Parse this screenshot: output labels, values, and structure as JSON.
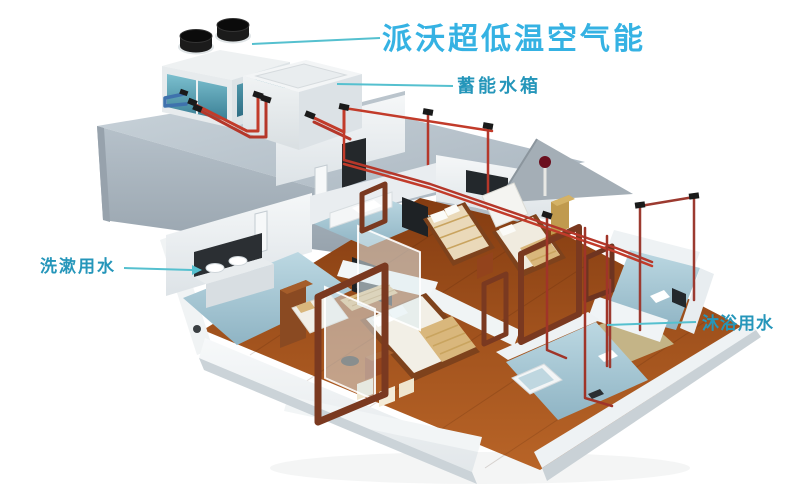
{
  "labels": {
    "system_title": {
      "text": "派沃超低温空气能",
      "color": "#35b2e3"
    },
    "storage_tank": {
      "text": "蓄能水箱",
      "color": "#2596ba"
    },
    "washing_water": {
      "text": "洗漱用水",
      "color": "#2596ba"
    },
    "bathing_water": {
      "text": "沐浴用水",
      "color": "#2596ba"
    }
  },
  "leader_lines": {
    "color": "#55c0cf",
    "washing_line_has_arrow": true
  },
  "colors": {
    "pipe_red": "#c23b2a",
    "pipe_dark_red": "#9c3a30",
    "pipe_blue": "#3f72ad",
    "fitting_black": "#1a1a1a",
    "tile_blue": "#a9cbd9",
    "wood_floor": "#9c4f1e",
    "platform_gray": "#b7c2cb",
    "wall_white": "#f2f4f5",
    "glass_teal": "#4f98ab"
  },
  "components": {
    "heat_pump": "air-source-heat-pump-unit",
    "tank": "thermal-storage-water-tank",
    "rooftop": "rooftop-platform",
    "bathroom_left": "washing-water-bathroom",
    "bathroom_middle": "upper-bathroom",
    "bathroom_right": "bathing-water-bathroom",
    "bathroom_bottom": "lower-bathroom",
    "bedrooms": "bedrooms-with-beds",
    "piping": "hot-water-piping-network"
  }
}
